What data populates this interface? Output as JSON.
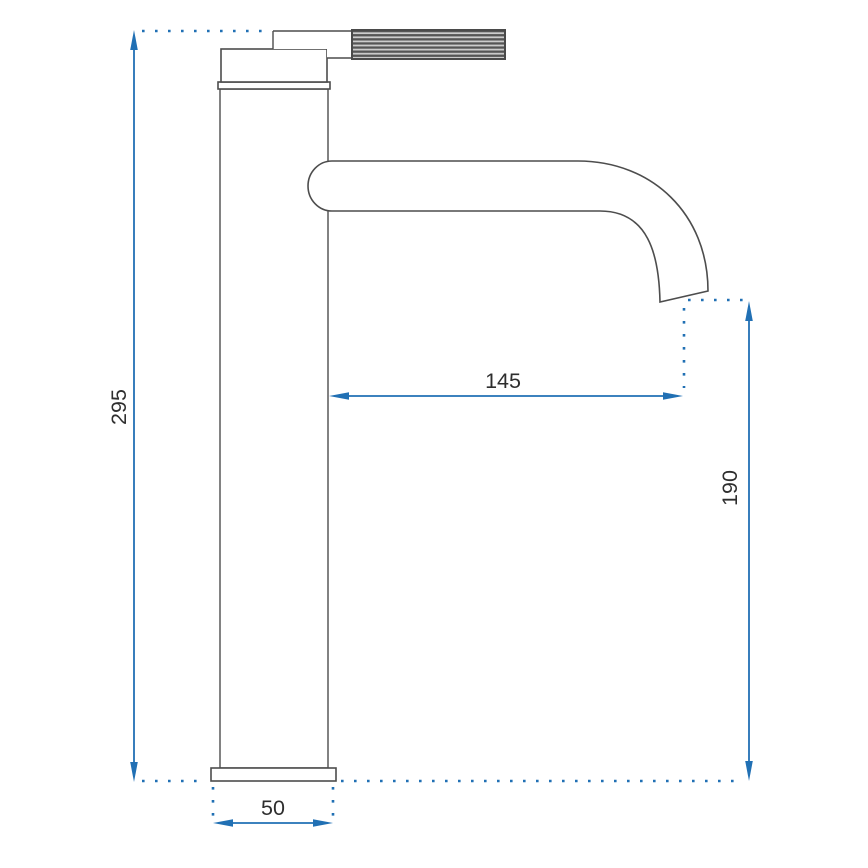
{
  "drawing": {
    "kind": "technical-dimension-drawing",
    "subject": "tall-single-lever-basin-faucet-side-view",
    "dimensions": {
      "total_height": {
        "label": "295",
        "orientation": "vertical"
      },
      "spout_reach": {
        "label": "145",
        "orientation": "horizontal"
      },
      "spout_outlet_height": {
        "label": "190",
        "orientation": "vertical"
      },
      "base_width": {
        "label": "50",
        "orientation": "horizontal"
      }
    },
    "colors": {
      "dimension_blue": "#2170b4",
      "outline_gray": "#4d4d4d",
      "label_text": "#2e2e2e",
      "background": "#ffffff"
    }
  }
}
